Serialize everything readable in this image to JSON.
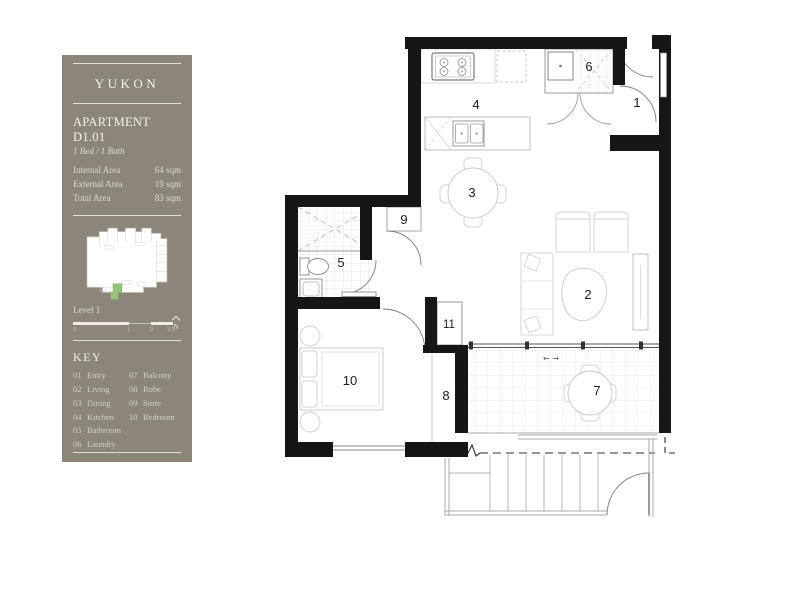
{
  "panel": {
    "building_name": "YUKON",
    "apartment": {
      "title": "APARTMENT D1.01",
      "configuration": "1 Bed / 1 Bath"
    },
    "areas": [
      {
        "label": "Internal Area",
        "value": "64 sqm"
      },
      {
        "label": "External Area",
        "value": "19 sqm"
      },
      {
        "label": "Total Area",
        "value": "83 sqm"
      }
    ],
    "level_label": "Level 1",
    "scale_ticks": [
      "0",
      "1",
      "2",
      "3.5"
    ],
    "north_label": "N",
    "key": {
      "title": "KEY",
      "column1": [
        {
          "num": "01",
          "label": "Entry"
        },
        {
          "num": "02",
          "label": "Living"
        },
        {
          "num": "03",
          "label": "Dining"
        },
        {
          "num": "04",
          "label": "Kitchen"
        },
        {
          "num": "05",
          "label": "Bathroom"
        },
        {
          "num": "06",
          "label": "Laundry"
        }
      ],
      "column2": [
        {
          "num": "07",
          "label": "Balcony"
        },
        {
          "num": "08",
          "label": "Robe"
        },
        {
          "num": "09",
          "label": "Store"
        },
        {
          "num": "10",
          "label": "Bedroom"
        }
      ]
    },
    "colors": {
      "panel_background": "#8b8679",
      "unit_highlight_green": "#98c27b"
    }
  },
  "floorplan": {
    "room_numbers": [
      "1",
      "2",
      "3",
      "4",
      "5",
      "6",
      "7",
      "8",
      "9",
      "10",
      "11"
    ],
    "sliding_door_arrows": "← →",
    "wall_color": "#161616"
  }
}
